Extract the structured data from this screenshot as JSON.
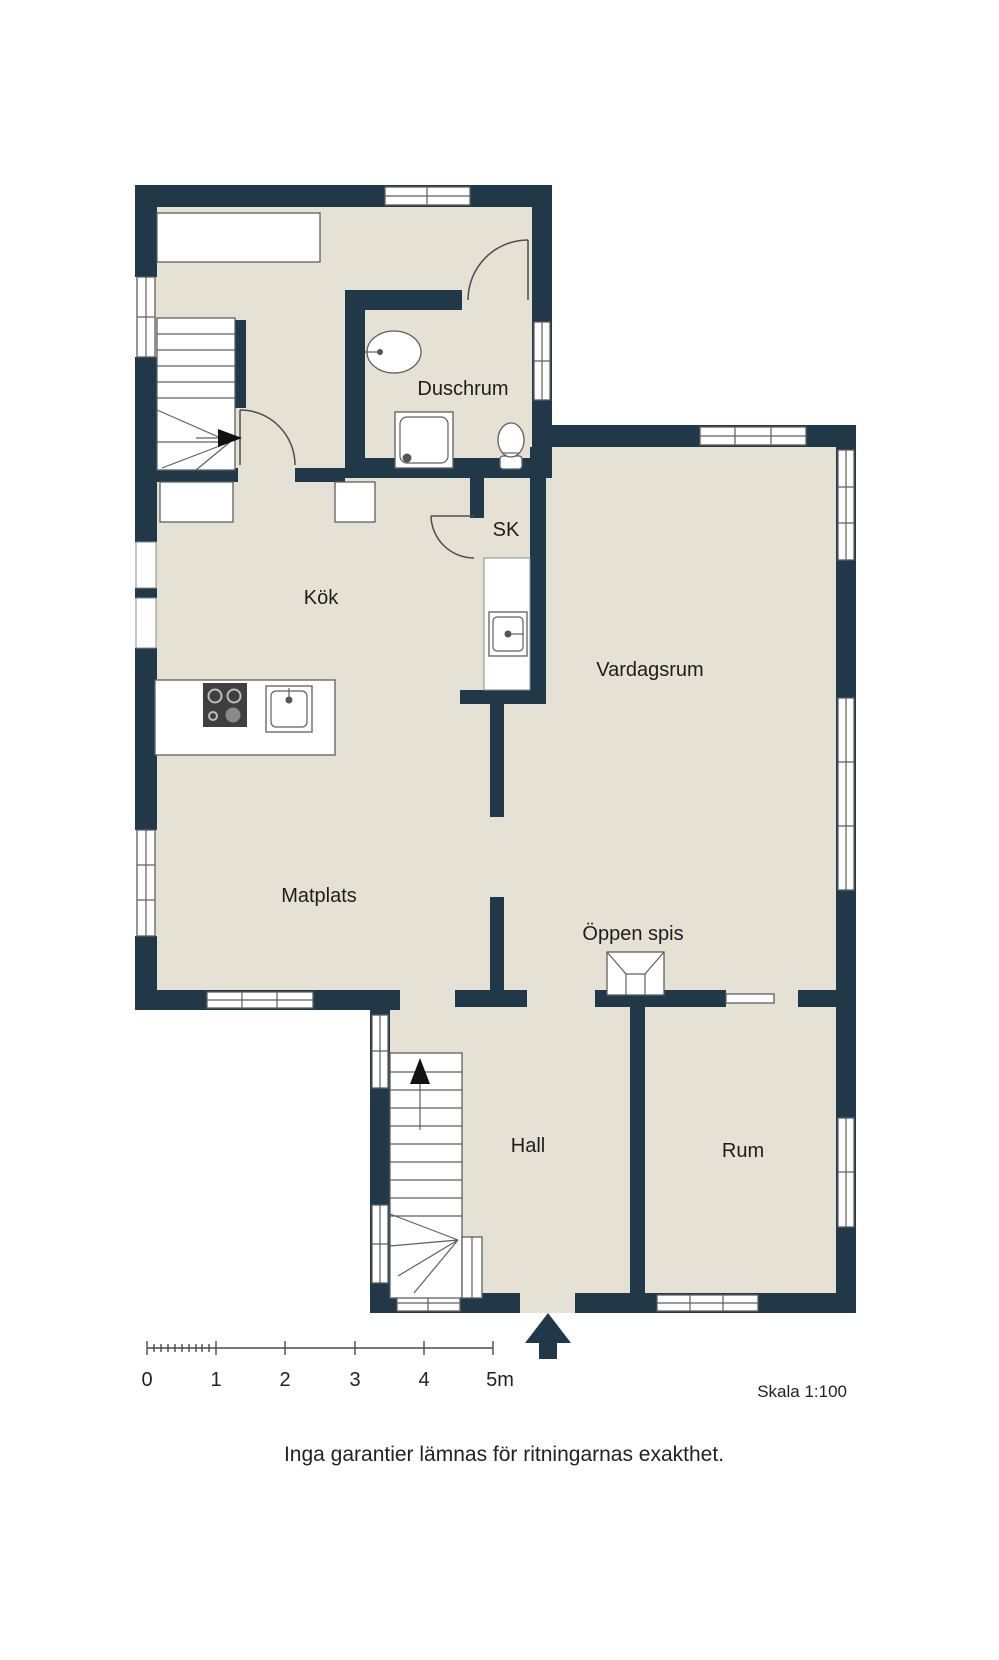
{
  "plan": {
    "type": "floor-plan",
    "scale_note": "Skala 1:100",
    "disclaimer": "Inga garantier lämnas för ritningarnas exakthet."
  },
  "rooms": [
    {
      "id": "duschrum",
      "label": "Duschrum"
    },
    {
      "id": "sk",
      "label": "SK"
    },
    {
      "id": "kok",
      "label": "Kök"
    },
    {
      "id": "vardagsrum",
      "label": "Vardagsrum"
    },
    {
      "id": "matplats",
      "label": "Matplats"
    },
    {
      "id": "oppen-spis",
      "label": "Öppen spis"
    },
    {
      "id": "hall",
      "label": "Hall"
    },
    {
      "id": "rum",
      "label": "Rum"
    }
  ],
  "scale_bar": {
    "tick_labels": [
      "0",
      "1",
      "2",
      "3",
      "4",
      "5m"
    ],
    "length_meters": 5
  },
  "fixtures": [
    "stairs-upper",
    "stairs-lower",
    "toilet",
    "washbasin",
    "shower",
    "kitchen-stove",
    "kitchen-sink",
    "utility-sink",
    "fireplace",
    "sliding-door",
    "entrance-arrow"
  ],
  "colors": {
    "wall": "#203848",
    "floor": "#e5e1d5",
    "background": "#ffffff",
    "fixture_line": "#5f5f5f",
    "text": "#1d1d1d",
    "scale_line": "#4a4a4a"
  }
}
